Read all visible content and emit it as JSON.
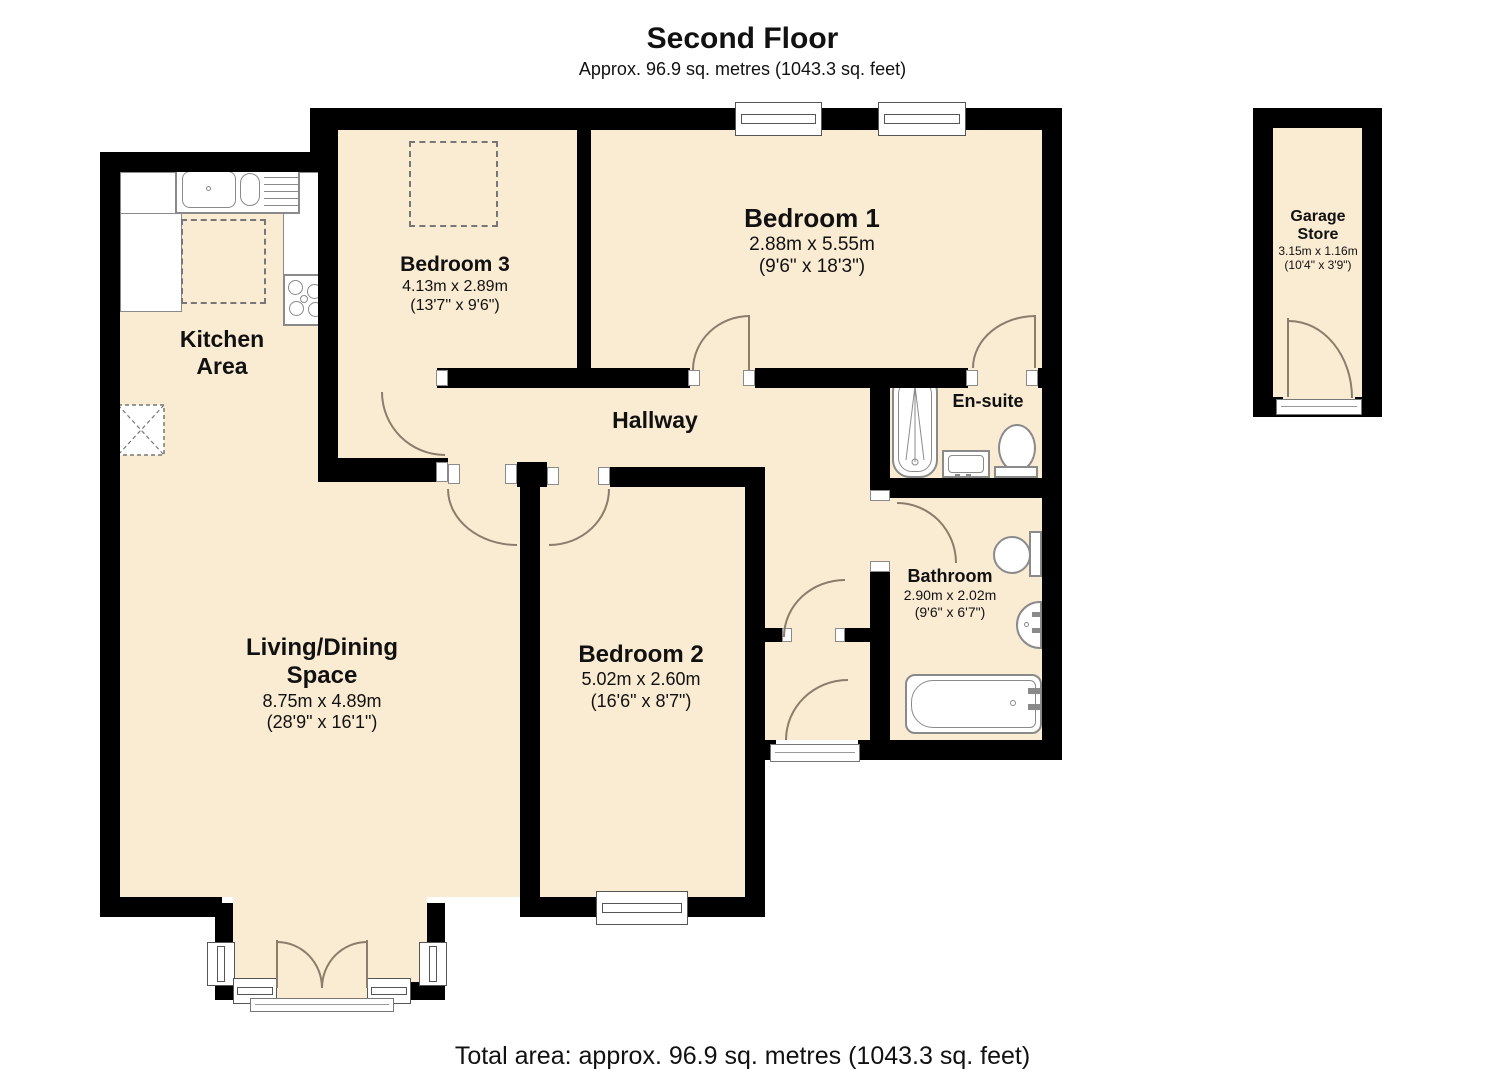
{
  "header": {
    "title": "Second Floor",
    "subtitle": "Approx. 96.9 sq. metres (1043.3 sq. feet)"
  },
  "footer": {
    "total_area": "Total area: approx. 96.9 sq. metres (1043.3 sq. feet)"
  },
  "rooms": {
    "bedroom1": {
      "name": "Bedroom 1",
      "metric": "2.88m x 5.55m",
      "imperial": "(9'6\" x 18'3\")"
    },
    "bedroom2": {
      "name": "Bedroom 2",
      "metric": "5.02m x 2.60m",
      "imperial": "(16'6\" x 8'7\")"
    },
    "bedroom3": {
      "name": "Bedroom 3",
      "metric": "4.13m x 2.89m",
      "imperial": "(13'7\" x 9'6\")"
    },
    "kitchen": {
      "name_line1": "Kitchen",
      "name_line2": "Area"
    },
    "living": {
      "name_line1": "Living/Dining",
      "name_line2": "Space",
      "metric": "8.75m x 4.89m",
      "imperial": "(28'9\" x 16'1\")"
    },
    "hallway": {
      "name": "Hallway"
    },
    "ensuite": {
      "name": "En-suite"
    },
    "bathroom": {
      "name": "Bathroom",
      "metric": "2.90m x 2.02m",
      "imperial": "(9'6\" x 6'7\")"
    },
    "garage": {
      "name_line1": "Garage",
      "name_line2": "Store",
      "metric": "3.15m x 1.16m",
      "imperial": "(10'4\" x 3'9\")"
    }
  },
  "colors": {
    "room_fill": "#FAEBD3",
    "wall": "#000000",
    "door_arc": "#8a7d6b",
    "fixture_outline": "#8a8a8a"
  }
}
